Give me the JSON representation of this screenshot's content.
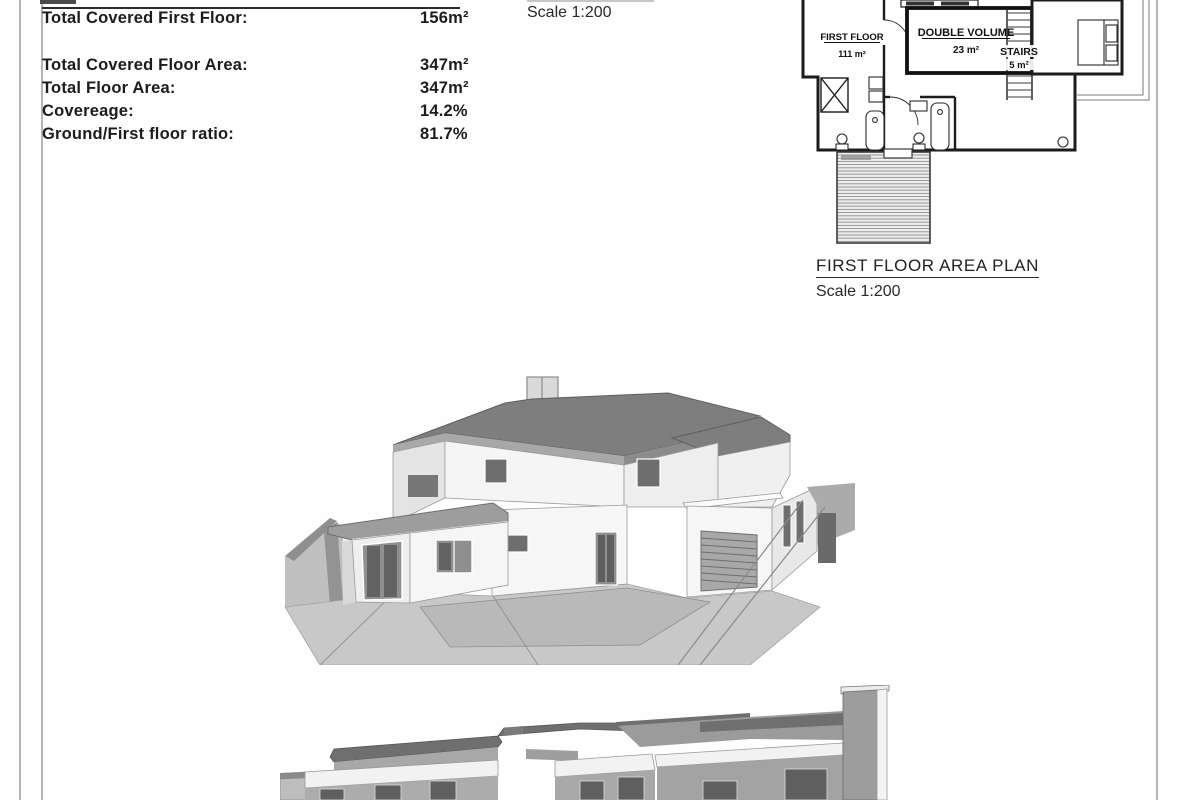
{
  "area_table": {
    "rows": [
      {
        "label": "Total Covered First Floor:",
        "value": "156m²"
      },
      {
        "label": "Total Covered Floor Area:",
        "value": "347m²"
      },
      {
        "label": "Total Floor Area:",
        "value": "347m²"
      },
      {
        "label": "Covereage:",
        "value": "14.2%"
      },
      {
        "label": "Ground/First floor ratio:",
        "value": "81.7%"
      }
    ]
  },
  "ground_floor_caption": {
    "scale": "Scale 1:200"
  },
  "first_floor_plan": {
    "title": "FIRST FLOOR AREA PLAN",
    "scale": "Scale 1:200",
    "rooms": [
      {
        "name": "FIRST FLOOR",
        "area": "111 m²"
      },
      {
        "name": "DOUBLE VOLUME",
        "area": "23 m²"
      },
      {
        "name": "STAIRS",
        "area": "5 m²"
      }
    ]
  },
  "colors": {
    "ink": "#1c1c1c",
    "frame_gray": "#b4b4b4",
    "roof_dark": "#7e7e7e",
    "wall_white": "#f5f5f5",
    "wall_shade": "#a8a8a8",
    "glass": "#6e6e6e",
    "ground": "#c8c8c8"
  }
}
